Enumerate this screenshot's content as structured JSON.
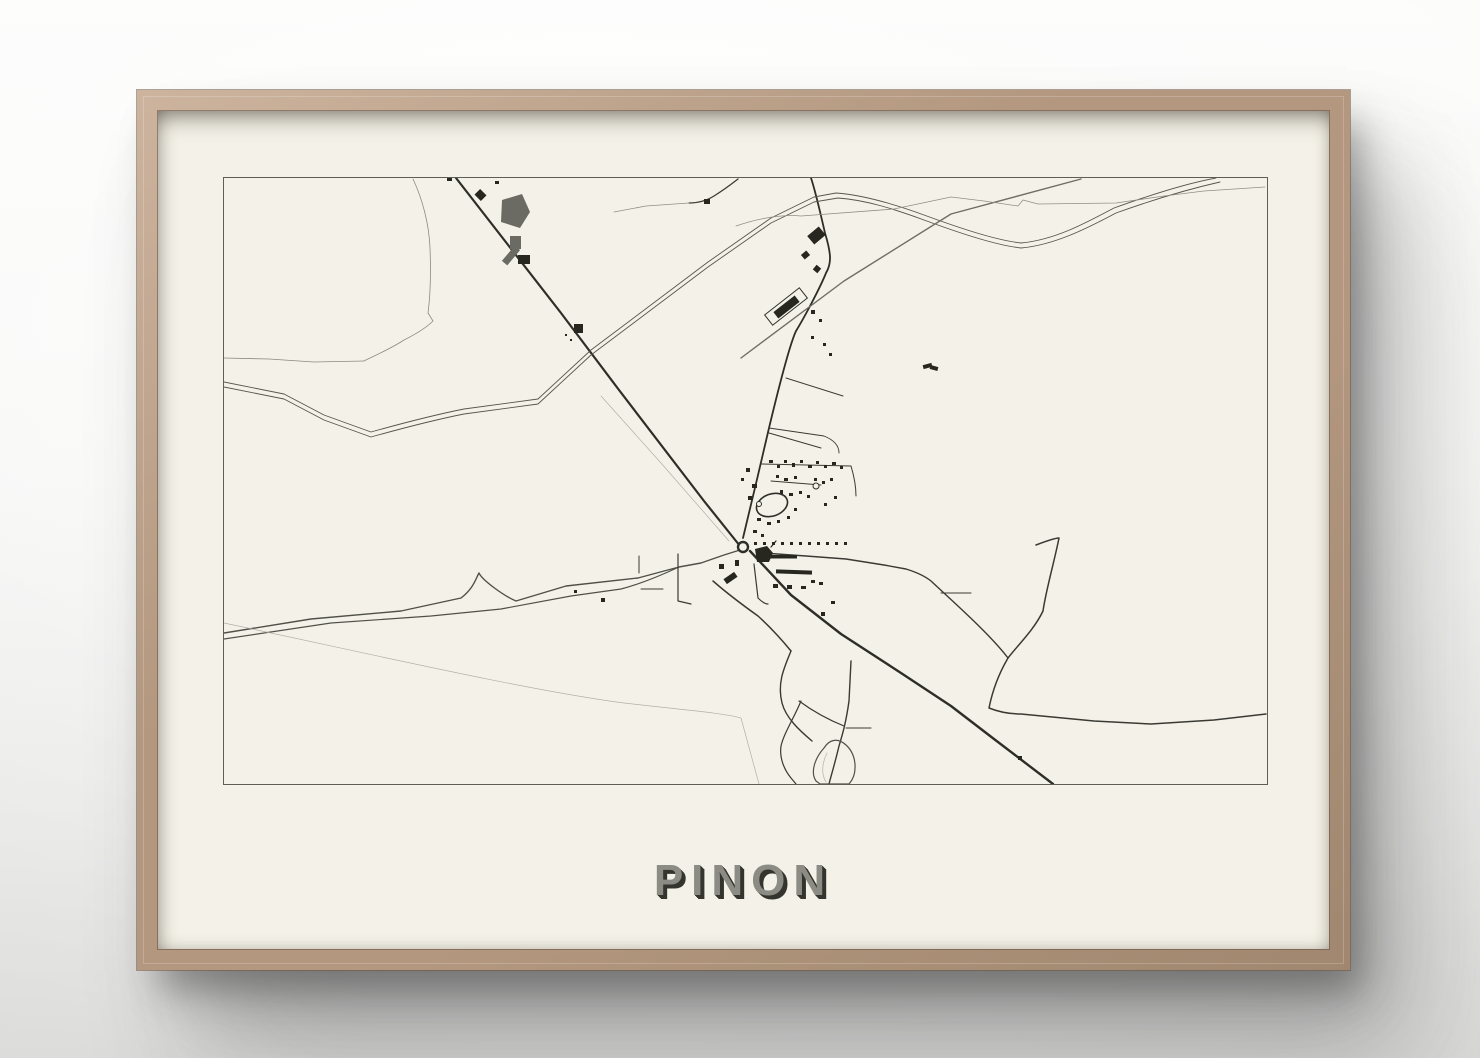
{
  "scene": {
    "wood_light": "#cdb49e",
    "wood": "#b3977f",
    "wood_dark": "#a1876f",
    "matte_color": "#f4f2e8"
  },
  "poster": {
    "title": "PINON",
    "title_color": "#8c8c85",
    "title_shadow_color": "#35352f",
    "map_border_color": "#5e5e56",
    "map_bg": "#f4f2e8"
  },
  "map": {
    "width": 1043,
    "height": 606,
    "building_color": "#27271f",
    "roads": [
      {
        "id": "main-straight-road",
        "d": "M232,0 L337,135 L395,212 L480,323 L516,368",
        "c": "#2e2e29",
        "w": 2.2
      },
      {
        "id": "main-road-southeast",
        "d": "M526,373 L567,417 L617,456 L677,495 L727,528 L770,561 L829,606",
        "c": "#2e2e29",
        "w": 2.4
      },
      {
        "id": "north-vertical-road",
        "d": "M587,0 C592,15 597,38 601,55 C607,75 608,85 602,95 C596,110 580,140 572,153 C565,168 551,225 545,250 C538,280 524,340 519,360",
        "c": "#2e2e29",
        "w": 1.8
      },
      {
        "id": "west-road-upper",
        "d": "M0,455 L87,441 L177,433 L237,420 C250,410 252,400 255,395 C258,402 280,418 292,423 L342,408 L414,400 L455,389 L477,385 L500,377 L516,372",
        "c": "#50504a",
        "w": 1.4
      },
      {
        "id": "west-road-lower",
        "d": "M0,461 L107,445 L207,438 L277,431 L347,418 L397,411 C420,405 440,396 455,389",
        "c": "#50504a",
        "w": 1.2
      },
      {
        "id": "railway-line-1",
        "d": "M0,204 L60,216 L100,237 L147,254 C190,242 215,236 240,231 L314,221 L367,172 L484,84 L547,40 L590,19 L612,15 C640,17 670,26 700,37 C730,48 770,62 797,65 C830,62 860,46 890,30 C940,12 970,4 992,0",
        "c": "#56564f",
        "w": 0.9
      },
      {
        "id": "railway-line-2",
        "d": "M0,209 L60,221 L100,242 L147,259 C190,247 215,241 240,236 L314,226 L367,177 L484,89 L547,45 L590,24 L614,20 C642,22 670,31 700,42 C730,53 770,67 797,70 C830,67 862,51 892,35 C942,17 974,9 996,4",
        "c": "#56564f",
        "w": 0.9
      },
      {
        "id": "gray-diagonal-road",
        "d": "M517,180 L620,103 L727,36 L857,1",
        "c": "#6e6e66",
        "w": 1.4
      },
      {
        "id": "thin-top-road",
        "d": "M512,48 C535,40 560,36 577,38 L670,31 L727,19 L760,23 L794,28 L799,22 L814,26 L892,25 L940,18 L980,13 L1041,9",
        "c": "#8f8f87",
        "w": 0.8
      },
      {
        "id": "top-hook-road",
        "d": "M514,1 C505,8 498,13 490,18 C482,23 473,25 465,25",
        "c": "#3c3c36",
        "w": 1.3
      },
      {
        "id": "top-hook-spur",
        "d": "M465,25 L422,28 L390,34",
        "c": "#8f8f87",
        "w": 0.8
      },
      {
        "id": "river",
        "d": "M189,1 C198,20 205,45 206,70 C207,95 206,120 204,135 L209,143 C202,150 190,157 180,162 C168,170 150,178 140,183",
        "c": "#8a8a82",
        "w": 0.8
      },
      {
        "id": "left-thin-stream",
        "d": "M0,180 L45,181 L90,184 L140,183",
        "c": "#8a8a82",
        "w": 0.8
      },
      {
        "id": "faint-path-parallel",
        "d": "M377,218 L437,285 L505,363",
        "c": "#b0b0a8",
        "w": 0.7
      },
      {
        "id": "faint-southwest-path",
        "d": "M0,445 C120,470 300,512 400,525 C460,532 500,535 517,540 L535,606",
        "c": "#b0b0a8",
        "w": 0.7
      },
      {
        "id": "southeast-branch-road",
        "d": "M489,403 C505,417 520,428 534,438 C545,448 558,462 567,473",
        "c": "#3a3a34",
        "w": 1.5
      },
      {
        "id": "south-wiggly-road",
        "d": "M567,473 C560,490 553,505 558,525 C562,540 575,552 588,563",
        "c": "#3a3a34",
        "w": 1.4
      },
      {
        "id": "south-branch",
        "d": "M575,523 C590,534 605,542 620,548",
        "c": "#3a3a34",
        "w": 1.2
      },
      {
        "id": "south-vertical-road",
        "d": "M627,483 L625,523 C622,545 618,558 615,568 C611,585 607,598 605,606",
        "c": "#3a3a34",
        "w": 1.4
      },
      {
        "id": "south-stub",
        "d": "M622,550 L647,550",
        "c": "#3a3a34",
        "w": 1.1
      },
      {
        "id": "south-left-branch",
        "d": "M577,523 C570,540 560,555 557,568 C555,582 562,594 567,600 L572,606",
        "c": "#3a3a34",
        "w": 1.2
      },
      {
        "id": "pond-outline",
        "d": "M600,570 C591,580 586,594 592,603 L596,606 L625,606 C634,596 633,577 622,567 C613,559 605,562 600,570 Z",
        "c": "#50504a",
        "w": 1.2
      },
      {
        "id": "pond-inner-path",
        "d": "M603,575 C598,585 597,596 602,604",
        "c": "#b9b9b0",
        "w": 0.8
      },
      {
        "id": "east-curvy-road",
        "d": "M812,367 C825,362 833,360 835,360 C830,385 822,412 819,433 C810,452 793,468 784,480 C774,497 768,515 765,530 C775,534 786,536 797,536 L870,543 L927,546 L990,542 L1042,536",
        "c": "#3a3a34",
        "w": 1.5
      },
      {
        "id": "east-street",
        "d": "M539,375 L582,378 L622,381 L660,387 L682,391 C695,395 702,399 707,403 C725,420 765,455 784,480",
        "c": "#3a3a34",
        "w": 1.4
      },
      {
        "id": "cross-street-stub",
        "d": "M717,415 L747,415",
        "c": "#3a3a34",
        "w": 1.1
      },
      {
        "id": "north-cluster-street-1",
        "d": "M537,286 L627,288 C630,298 632,308 632,318",
        "c": "#3a3a34",
        "w": 1.0
      },
      {
        "id": "north-cluster-street-2",
        "d": "M547,303 L597,307",
        "c": "#3a3a34",
        "w": 0.9
      },
      {
        "id": "north-cluster-street-3",
        "d": "M545,250 L600,258 C610,262 615,268 615,275",
        "c": "#3a3a34",
        "w": 0.9
      },
      {
        "id": "station-side-street",
        "d": "M562,200 L619,218",
        "c": "#3a3a34",
        "w": 1.0
      },
      {
        "id": "station-side-stub",
        "d": "M545,255 L597,270",
        "c": "#3a3a34",
        "w": 1.0
      },
      {
        "id": "south-center-street",
        "d": "M530,386 L534,420 C538,424 541,426 544,426",
        "c": "#3a3a34",
        "w": 1.2
      },
      {
        "id": "triangle-stub-vertical",
        "d": "M454,376 L454,423 L467,426",
        "c": "#3a3a34",
        "w": 1.2
      },
      {
        "id": "triangle-stub-horizontal",
        "d": "M417,411 L439,411",
        "c": "#3a3a34",
        "w": 1.0
      },
      {
        "id": "triangle-stub-vertical-2",
        "d": "M415,378 L415,395",
        "c": "#3a3a34",
        "w": 1.0
      },
      {
        "id": "church-flag-tick",
        "d": "M547,369 L552,363",
        "c": "#27271f",
        "w": 1.2
      }
    ],
    "ellipses": [
      {
        "id": "roundabout",
        "cx": 519,
        "cy": 369,
        "rx": 5,
        "ry": 5,
        "w": 2.4,
        "c": "#2e2e29",
        "f": "#f4f2e8"
      },
      {
        "id": "stadium-loop",
        "cx": 548,
        "cy": 327,
        "rx": 16,
        "ry": 11,
        "rot": -20,
        "w": 1.6,
        "c": "#2e2e29",
        "f": "none"
      },
      {
        "id": "small-circle-west",
        "cx": 535,
        "cy": 326,
        "rx": 2.5,
        "ry": 2.5,
        "w": 1,
        "c": "#2e2e29",
        "f": "#f4f2e8"
      },
      {
        "id": "small-circle-north",
        "cx": 592,
        "cy": 308,
        "rx": 3,
        "ry": 3,
        "w": 1,
        "c": "#2e2e29",
        "f": "#f4f2e8"
      }
    ],
    "polygons": [
      {
        "id": "gray-pond-blob",
        "points": "278,22 298,16 306,34 296,50 277,44",
        "f": "#6b6b63"
      },
      {
        "id": "church-building",
        "points": "531,371 543,368 549,375 545,384 533,384",
        "f": "#27271f"
      }
    ],
    "buildings": [
      {
        "x": 286,
        "y": 58,
        "w": 11,
        "h": 13,
        "f": "#6b6b63"
      },
      {
        "x": 277,
        "y": 74,
        "w": 20,
        "h": 7,
        "r": -50,
        "f": "#6b6b63"
      },
      {
        "x": 252,
        "y": 13,
        "w": 9,
        "h": 8,
        "r": 45
      },
      {
        "x": 294,
        "y": 77,
        "w": 12,
        "h": 9
      },
      {
        "x": 271,
        "y": 3,
        "w": 4,
        "h": 3
      },
      {
        "x": 223,
        "y": 0,
        "w": 5,
        "h": 3
      },
      {
        "x": 350,
        "y": 146,
        "w": 9,
        "h": 9
      },
      {
        "x": 341,
        "y": 156,
        "w": 2,
        "h": 2
      },
      {
        "x": 346,
        "y": 161,
        "w": 2,
        "h": 2
      },
      {
        "x": 480,
        "y": 21,
        "w": 6,
        "h": 5
      },
      {
        "x": 585,
        "y": 52,
        "w": 15,
        "h": 11,
        "r": -40
      },
      {
        "x": 578,
        "y": 74,
        "w": 7,
        "h": 6,
        "r": -40
      },
      {
        "x": 590,
        "y": 88,
        "w": 6,
        "h": 6,
        "r": 40
      },
      {
        "x": 587,
        "y": 132,
        "w": 4,
        "h": 4
      },
      {
        "x": 595,
        "y": 141,
        "w": 3,
        "h": 3
      },
      {
        "x": 587,
        "y": 158,
        "w": 3,
        "h": 3
      },
      {
        "x": 599,
        "y": 165,
        "w": 3,
        "h": 3
      },
      {
        "x": 605,
        "y": 175,
        "w": 3,
        "h": 3
      },
      {
        "x": 540,
        "y": 122,
        "w": 44,
        "h": 13,
        "r": -38,
        "f": "#f4f2e8",
        "s": "#30302b"
      },
      {
        "x": 549,
        "y": 125,
        "w": 27,
        "h": 8,
        "r": -38
      },
      {
        "x": 699,
        "y": 186,
        "w": 9,
        "h": 4,
        "r": -15
      },
      {
        "x": 706,
        "y": 188,
        "w": 8,
        "h": 4,
        "r": 15
      },
      {
        "x": 545,
        "y": 282,
        "w": 4,
        "h": 3
      },
      {
        "x": 553,
        "y": 287,
        "w": 3,
        "h": 3
      },
      {
        "x": 560,
        "y": 282,
        "w": 3,
        "h": 3
      },
      {
        "x": 568,
        "y": 285,
        "w": 3,
        "h": 4
      },
      {
        "x": 576,
        "y": 282,
        "w": 3,
        "h": 3
      },
      {
        "x": 584,
        "y": 287,
        "w": 4,
        "h": 3
      },
      {
        "x": 592,
        "y": 283,
        "w": 3,
        "h": 3
      },
      {
        "x": 600,
        "y": 287,
        "w": 3,
        "h": 3
      },
      {
        "x": 608,
        "y": 284,
        "w": 4,
        "h": 3
      },
      {
        "x": 616,
        "y": 288,
        "w": 3,
        "h": 3
      },
      {
        "x": 552,
        "y": 297,
        "w": 3,
        "h": 3
      },
      {
        "x": 560,
        "y": 300,
        "w": 4,
        "h": 3
      },
      {
        "x": 570,
        "y": 298,
        "w": 3,
        "h": 3
      },
      {
        "x": 590,
        "y": 300,
        "w": 3,
        "h": 3
      },
      {
        "x": 598,
        "y": 303,
        "w": 3,
        "h": 3
      },
      {
        "x": 606,
        "y": 300,
        "w": 3,
        "h": 3
      },
      {
        "x": 556,
        "y": 312,
        "w": 3,
        "h": 4
      },
      {
        "x": 565,
        "y": 315,
        "w": 4,
        "h": 3
      },
      {
        "x": 575,
        "y": 313,
        "w": 3,
        "h": 3
      },
      {
        "x": 583,
        "y": 317,
        "w": 3,
        "h": 3
      },
      {
        "x": 528,
        "y": 306,
        "w": 5,
        "h": 4
      },
      {
        "x": 524,
        "y": 318,
        "w": 4,
        "h": 4
      },
      {
        "x": 533,
        "y": 340,
        "w": 4,
        "h": 3
      },
      {
        "x": 543,
        "y": 344,
        "w": 4,
        "h": 3
      },
      {
        "x": 553,
        "y": 342,
        "w": 3,
        "h": 3
      },
      {
        "x": 563,
        "y": 338,
        "w": 3,
        "h": 3
      },
      {
        "x": 570,
        "y": 330,
        "w": 3,
        "h": 3
      },
      {
        "x": 529,
        "y": 352,
        "w": 4,
        "h": 3
      },
      {
        "x": 537,
        "y": 356,
        "w": 3,
        "h": 3
      },
      {
        "x": 522,
        "y": 290,
        "w": 4,
        "h": 4
      },
      {
        "x": 517,
        "y": 300,
        "w": 3,
        "h": 3
      },
      {
        "x": 610,
        "y": 318,
        "w": 3,
        "h": 3
      },
      {
        "x": 600,
        "y": 325,
        "w": 3,
        "h": 3
      },
      {
        "x": 530,
        "y": 364,
        "w": 3,
        "h": 3
      },
      {
        "x": 539,
        "y": 364,
        "w": 3,
        "h": 3
      },
      {
        "x": 548,
        "y": 364,
        "w": 3,
        "h": 3
      },
      {
        "x": 557,
        "y": 364,
        "w": 3,
        "h": 3
      },
      {
        "x": 566,
        "y": 364,
        "w": 3,
        "h": 3
      },
      {
        "x": 575,
        "y": 364,
        "w": 3,
        "h": 3
      },
      {
        "x": 584,
        "y": 364,
        "w": 3,
        "h": 3
      },
      {
        "x": 593,
        "y": 364,
        "w": 3,
        "h": 3
      },
      {
        "x": 602,
        "y": 364,
        "w": 3,
        "h": 3
      },
      {
        "x": 611,
        "y": 364,
        "w": 3,
        "h": 3
      },
      {
        "x": 620,
        "y": 364,
        "w": 3,
        "h": 3
      },
      {
        "x": 545,
        "y": 377,
        "w": 28,
        "h": 3.5
      },
      {
        "x": 552,
        "y": 392,
        "w": 36,
        "h": 4,
        "r": 2
      },
      {
        "x": 549,
        "y": 406,
        "w": 5,
        "h": 4
      },
      {
        "x": 563,
        "y": 407,
        "w": 5,
        "h": 4
      },
      {
        "x": 577,
        "y": 408,
        "w": 5,
        "h": 3
      },
      {
        "x": 587,
        "y": 402,
        "w": 4,
        "h": 3
      },
      {
        "x": 595,
        "y": 404,
        "w": 4,
        "h": 3
      },
      {
        "x": 495,
        "y": 386,
        "w": 5,
        "h": 5
      },
      {
        "x": 500,
        "y": 397,
        "w": 13,
        "h": 6,
        "r": -35
      },
      {
        "x": 511,
        "y": 382,
        "w": 4,
        "h": 6
      },
      {
        "x": 597,
        "y": 434,
        "w": 4,
        "h": 4
      },
      {
        "x": 607,
        "y": 423,
        "w": 4,
        "h": 3
      },
      {
        "x": 794,
        "y": 578,
        "w": 4,
        "h": 4
      },
      {
        "x": 350,
        "y": 412,
        "w": 3,
        "h": 3
      },
      {
        "x": 377,
        "y": 420,
        "w": 4,
        "h": 4
      }
    ]
  }
}
